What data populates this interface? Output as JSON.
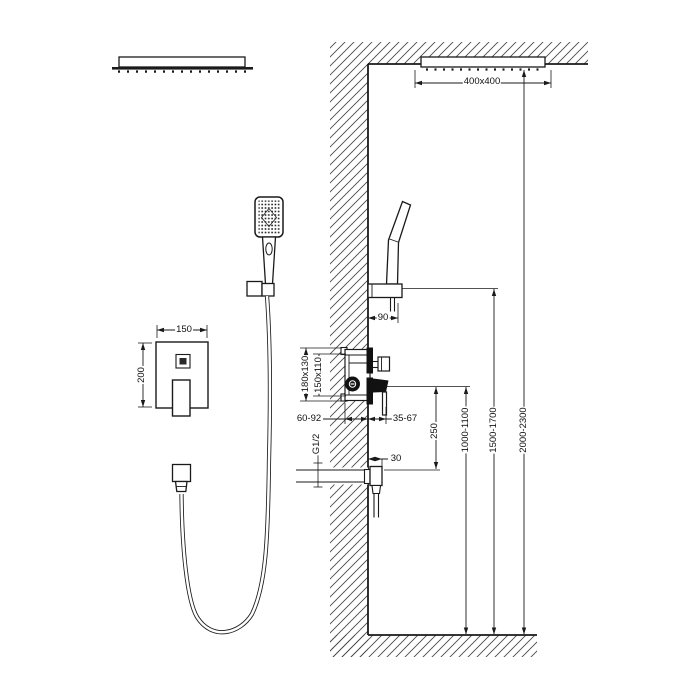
{
  "drawing": {
    "background": "#ffffff",
    "line_color": "#1a1a1a",
    "hatch_color": "#4a4a4a",
    "labels": {
      "overhead_size": "400x400",
      "overhead_height": "2000-2300",
      "handshower_height": "1500-1700",
      "mixer_height": "1000-1100",
      "outlet_drop": "250",
      "handshower_offset": "90",
      "plate_width": "150",
      "plate_height": "200",
      "rough_in_outer": "180x130",
      "rough_in_cutout": "150x110",
      "rough_in_depth": "60-92",
      "trim_protrusion": "35-67",
      "outlet_protrusion": "30",
      "thread_size": "G1/2"
    }
  }
}
